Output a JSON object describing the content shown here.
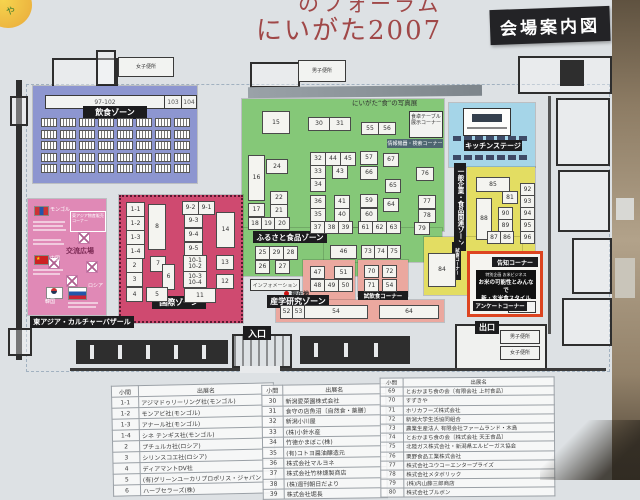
{
  "photo": {
    "title_top": "のフォーラム",
    "title_main": "にいがた2007",
    "badge": "会場案内図"
  },
  "labels": {
    "entrance": "入口",
    "exit": "出口",
    "photo_exhibit": "にいがた“食”の写真展",
    "table_display_lines": [
      "食卓テーブル",
      "展示コーナー"
    ],
    "search_corner": "情報機器・検索コーナー",
    "wc_female": "女子便所",
    "wc_male": "男子便所"
  },
  "zones": {
    "dining": {
      "label": "飲食ゾーン",
      "strip_label": "97-102",
      "cell_103": "103",
      "cell_104": "104",
      "color": "#8d96d0"
    },
    "furusato": {
      "label": "ふるさと食品ゾーン",
      "color": "#85c878",
      "booths": [
        {
          "n": "15",
          "x": 262,
          "y": 111,
          "w": 26,
          "h": 21
        },
        {
          "n": "30",
          "x": 308,
          "y": 117,
          "w": 20,
          "h": 12
        },
        {
          "n": "31",
          "x": 329,
          "y": 117,
          "w": 20,
          "h": 12
        },
        {
          "n": "55",
          "x": 361,
          "y": 122,
          "w": 16,
          "h": 11
        },
        {
          "n": "56",
          "x": 378,
          "y": 122,
          "w": 16,
          "h": 11
        },
        {
          "n": "16",
          "x": 248,
          "y": 155,
          "w": 15,
          "h": 44
        },
        {
          "n": "24",
          "x": 266,
          "y": 159,
          "w": 20,
          "h": 13
        },
        {
          "n": "22",
          "x": 270,
          "y": 191,
          "w": 16,
          "h": 12
        },
        {
          "n": "21",
          "x": 270,
          "y": 204,
          "w": 16,
          "h": 12
        },
        {
          "n": "17",
          "x": 248,
          "y": 203,
          "w": 15,
          "h": 12
        },
        {
          "n": "18",
          "x": 248,
          "y": 217,
          "w": 12,
          "h": 11
        },
        {
          "n": "19",
          "x": 261,
          "y": 217,
          "w": 12,
          "h": 11
        },
        {
          "n": "20",
          "x": 274,
          "y": 217,
          "w": 14,
          "h": 11
        },
        {
          "n": "32",
          "x": 310,
          "y": 152,
          "w": 14,
          "h": 12
        },
        {
          "n": "44",
          "x": 325,
          "y": 152,
          "w": 14,
          "h": 12
        },
        {
          "n": "45",
          "x": 340,
          "y": 152,
          "w": 14,
          "h": 12
        },
        {
          "n": "33",
          "x": 310,
          "y": 165,
          "w": 14,
          "h": 12
        },
        {
          "n": "43",
          "x": 332,
          "y": 165,
          "w": 14,
          "h": 12
        },
        {
          "n": "34",
          "x": 310,
          "y": 178,
          "w": 14,
          "h": 12
        },
        {
          "n": "36",
          "x": 310,
          "y": 195,
          "w": 14,
          "h": 12
        },
        {
          "n": "41",
          "x": 334,
          "y": 195,
          "w": 14,
          "h": 12
        },
        {
          "n": "35",
          "x": 310,
          "y": 208,
          "w": 14,
          "h": 12
        },
        {
          "n": "40",
          "x": 334,
          "y": 208,
          "w": 14,
          "h": 12
        },
        {
          "n": "37",
          "x": 310,
          "y": 221,
          "w": 13,
          "h": 11
        },
        {
          "n": "38",
          "x": 324,
          "y": 221,
          "w": 13,
          "h": 11
        },
        {
          "n": "39",
          "x": 338,
          "y": 221,
          "w": 13,
          "h": 11
        },
        {
          "n": "57",
          "x": 360,
          "y": 151,
          "w": 16,
          "h": 12
        },
        {
          "n": "67",
          "x": 383,
          "y": 153,
          "w": 14,
          "h": 12
        },
        {
          "n": "66",
          "x": 360,
          "y": 166,
          "w": 16,
          "h": 12
        },
        {
          "n": "65",
          "x": 385,
          "y": 179,
          "w": 14,
          "h": 12
        },
        {
          "n": "59",
          "x": 360,
          "y": 194,
          "w": 16,
          "h": 12
        },
        {
          "n": "64",
          "x": 383,
          "y": 198,
          "w": 14,
          "h": 12
        },
        {
          "n": "60",
          "x": 360,
          "y": 208,
          "w": 16,
          "h": 12
        },
        {
          "n": "61",
          "x": 358,
          "y": 221,
          "w": 13,
          "h": 11
        },
        {
          "n": "62",
          "x": 372,
          "y": 221,
          "w": 13,
          "h": 11
        },
        {
          "n": "63",
          "x": 386,
          "y": 221,
          "w": 13,
          "h": 11
        },
        {
          "n": "76",
          "x": 416,
          "y": 167,
          "w": 16,
          "h": 12
        },
        {
          "n": "77",
          "x": 418,
          "y": 195,
          "w": 16,
          "h": 12
        },
        {
          "n": "78",
          "x": 418,
          "y": 209,
          "w": 16,
          "h": 12
        },
        {
          "n": "79",
          "x": 414,
          "y": 222,
          "w": 14,
          "h": 11
        },
        {
          "n": "25",
          "x": 255,
          "y": 246,
          "w": 13,
          "h": 12
        },
        {
          "n": "29",
          "x": 269,
          "y": 246,
          "w": 13,
          "h": 12
        },
        {
          "n": "28",
          "x": 283,
          "y": 246,
          "w": 13,
          "h": 12
        },
        {
          "n": "26",
          "x": 255,
          "y": 260,
          "w": 13,
          "h": 12
        },
        {
          "n": "27",
          "x": 275,
          "y": 260,
          "w": 13,
          "h": 12
        },
        {
          "n": "46",
          "x": 330,
          "y": 245,
          "w": 25,
          "h": 12
        },
        {
          "n": "73",
          "x": 361,
          "y": 245,
          "w": 12,
          "h": 12
        },
        {
          "n": "74",
          "x": 374,
          "y": 245,
          "w": 12,
          "h": 12
        },
        {
          "n": "75",
          "x": 387,
          "y": 245,
          "w": 12,
          "h": 12
        }
      ]
    },
    "international": {
      "label": "国際ゾーン",
      "color": "#cf4a70",
      "booths": [
        {
          "n": "1-1",
          "x": 126,
          "y": 202,
          "w": 17,
          "h": 13
        },
        {
          "n": "1-2",
          "x": 126,
          "y": 216,
          "w": 17,
          "h": 13
        },
        {
          "n": "1-3",
          "x": 126,
          "y": 230,
          "w": 17,
          "h": 13
        },
        {
          "n": "1-4",
          "x": 126,
          "y": 244,
          "w": 17,
          "h": 13
        },
        {
          "n": "8",
          "x": 148,
          "y": 204,
          "w": 16,
          "h": 44
        },
        {
          "n": "9-2",
          "x": 182,
          "y": 201,
          "w": 15,
          "h": 12
        },
        {
          "n": "9-1",
          "x": 198,
          "y": 201,
          "w": 15,
          "h": 12
        },
        {
          "n": "9-3",
          "x": 184,
          "y": 214,
          "w": 17,
          "h": 12
        },
        {
          "n": "9-4",
          "x": 184,
          "y": 228,
          "w": 17,
          "h": 12
        },
        {
          "n": "9-5",
          "x": 184,
          "y": 242,
          "w": 17,
          "h": 12
        },
        {
          "n": "14",
          "x": 216,
          "y": 212,
          "w": 17,
          "h": 34
        },
        {
          "n": "2",
          "x": 126,
          "y": 258,
          "w": 15,
          "h": 13
        },
        {
          "n": "7",
          "x": 150,
          "y": 256,
          "w": 14,
          "h": 14
        },
        {
          "n": "3",
          "x": 126,
          "y": 272,
          "w": 15,
          "h": 13
        },
        {
          "n": "6",
          "x": 162,
          "y": 264,
          "w": 11,
          "h": 24
        },
        {
          "n": "4",
          "x": 126,
          "y": 287,
          "w": 15,
          "h": 13
        },
        {
          "n": "5",
          "x": 146,
          "y": 287,
          "w": 20,
          "h": 13
        },
        {
          "n": "10-1|10-2",
          "x": 183,
          "y": 255,
          "w": 22,
          "h": 15
        },
        {
          "n": "10-3|10-4",
          "x": 183,
          "y": 271,
          "w": 22,
          "h": 15
        },
        {
          "n": "13",
          "x": 216,
          "y": 255,
          "w": 16,
          "h": 13
        },
        {
          "n": "12",
          "x": 216,
          "y": 274,
          "w": 16,
          "h": 13
        },
        {
          "n": "11",
          "x": 184,
          "y": 288,
          "w": 30,
          "h": 13
        }
      ]
    },
    "bazaar": {
      "label": "東アジア・カルチャーバザール",
      "color": "#e089b6",
      "plaza_label": "交流広場",
      "corner_label": "東アジア物産販売コーナー",
      "mongolia": "モンゴル",
      "china": "中国",
      "korea": "韓国",
      "russia": "ロシア"
    },
    "sangaku": {
      "label": "産学研究ゾーン",
      "color": "#eba89f",
      "info_label": "インフォメーション",
      "current_label": "現在地",
      "tasting_label": "試飲食コーナー",
      "booths": [
        {
          "n": "47",
          "x": 310,
          "y": 266,
          "w": 13,
          "h": 11
        },
        {
          "n": "51",
          "x": 334,
          "y": 266,
          "w": 17,
          "h": 11
        },
        {
          "n": "48",
          "x": 310,
          "y": 279,
          "w": 13,
          "h": 11
        },
        {
          "n": "49",
          "x": 324,
          "y": 279,
          "w": 13,
          "h": 11
        },
        {
          "n": "50",
          "x": 338,
          "y": 279,
          "w": 13,
          "h": 11
        },
        {
          "n": "70",
          "x": 364,
          "y": 265,
          "w": 13,
          "h": 11
        },
        {
          "n": "72",
          "x": 382,
          "y": 265,
          "w": 13,
          "h": 11
        },
        {
          "n": "71",
          "x": 364,
          "y": 279,
          "w": 13,
          "h": 11
        },
        {
          "n": "54",
          "x": 382,
          "y": 279,
          "w": 13,
          "h": 11
        },
        {
          "n": "52",
          "x": 280,
          "y": 305,
          "w": 11,
          "h": 12
        },
        {
          "n": "53",
          "x": 292,
          "y": 305,
          "w": 11,
          "h": 12
        },
        {
          "n": "54",
          "x": 304,
          "y": 305,
          "w": 62,
          "h": 12
        },
        {
          "n": "64",
          "x": 379,
          "y": 305,
          "w": 58,
          "h": 12
        }
      ]
    },
    "kitchen": {
      "label": "キッチンステージ",
      "color": "#a5d5e8"
    },
    "general": {
      "label": "一般企業・食品関連ゾーン",
      "color": "#e3dd62",
      "mini_label": "試食コーナー",
      "booths": [
        {
          "n": "85",
          "x": 476,
          "y": 177,
          "w": 32,
          "h": 13
        },
        {
          "n": "81",
          "x": 502,
          "y": 191,
          "w": 14,
          "h": 11
        },
        {
          "n": "88",
          "x": 476,
          "y": 198,
          "w": 14,
          "h": 40
        },
        {
          "n": "90",
          "x": 498,
          "y": 207,
          "w": 13,
          "h": 11
        },
        {
          "n": "89",
          "x": 498,
          "y": 219,
          "w": 13,
          "h": 11
        },
        {
          "n": "87",
          "x": 487,
          "y": 231,
          "w": 12,
          "h": 11
        },
        {
          "n": "86",
          "x": 500,
          "y": 231,
          "w": 12,
          "h": 11
        },
        {
          "n": "92",
          "x": 520,
          "y": 183,
          "w": 13,
          "h": 11
        },
        {
          "n": "93",
          "x": 520,
          "y": 195,
          "w": 13,
          "h": 11
        },
        {
          "n": "94",
          "x": 520,
          "y": 207,
          "w": 13,
          "h": 11
        },
        {
          "n": "95",
          "x": 520,
          "y": 219,
          "w": 13,
          "h": 11
        },
        {
          "n": "96",
          "x": 520,
          "y": 231,
          "w": 13,
          "h": 11
        },
        {
          "n": "84",
          "x": 428,
          "y": 253,
          "w": 26,
          "h": 32
        }
      ]
    },
    "notice": {
      "label": "告知コーナー",
      "lines": [
        "特別企画 お米ビジネス",
        "お米の可能性とみんなで",
        "新・玄米食スタイル"
      ],
      "survey_label": "アンケートコーナー",
      "border_color": "#dd4420"
    }
  },
  "table": {
    "groups": [
      {
        "headers": [
          "小間",
          "出展名"
        ],
        "rows": [
          [
            "1-1",
            "アジマドゥリーリング社(モンゴル)"
          ],
          [
            "1-2",
            "モンアビ社(モンゴル)"
          ],
          [
            "1-3",
            "アナール社(モンゴル)"
          ],
          [
            "1-4",
            "シネ テンギス社(モンゴル)"
          ],
          [
            "2",
            "プチュルカ社(ロシア)"
          ],
          [
            "3",
            "シリンスコエ社(ロシア)"
          ],
          [
            "4",
            "ディアマントDV社"
          ],
          [
            "5",
            "(有)グリーンユーカリプロポリス・ジャパン"
          ],
          [
            "6",
            "ハーブセラーズ(株)"
          ]
        ]
      },
      {
        "headers": [
          "小間",
          "出展名"
        ],
        "rows": [
          [
            "30",
            "新潟愛菜園株式会社"
          ],
          [
            "31",
            "食守の店魚沼〔自然食・薬膳〕"
          ],
          [
            "32",
            "新潟小川屋"
          ],
          [
            "33",
            "(株)小針水産"
          ],
          [
            "34",
            "竹徳かまぼこ(株)"
          ],
          [
            "35",
            "(有)コトヨ醤油醸造元"
          ],
          [
            "36",
            "株式会社マルヨネ"
          ],
          [
            "37",
            "株式会社竹林燻製商店"
          ],
          [
            "38",
            "(株)週刊朝日だより"
          ],
          [
            "39",
            "株式会社堀長"
          ]
        ]
      },
      {
        "headers": [
          "小間",
          "出展名"
        ],
        "rows": [
          [
            "69",
            "とおかまち食の会〔有限会社 上村食品〕"
          ],
          [
            "70",
            "すずきや"
          ],
          [
            "71",
            "ホリカフーズ株式会社"
          ],
          [
            "72",
            "新潟大学生活協同組合"
          ],
          [
            "73",
            "農業生産法人 有限会社ファームランド・木島"
          ],
          [
            "74",
            "とおかまち食の会〔株式会社 天王食品〕"
          ],
          [
            "75",
            "北陸ガス株式会社・新潟県エルピーガス協会"
          ],
          [
            "76",
            "栗野食品工業株式会社"
          ],
          [
            "77",
            "株式会社ユウコーエンタープライズ"
          ],
          [
            "78",
            "株式会社メタボリック"
          ],
          [
            "79",
            "(株)内山藤三郎商店"
          ],
          [
            "80",
            "株式会社ブルボン"
          ]
        ]
      }
    ]
  }
}
